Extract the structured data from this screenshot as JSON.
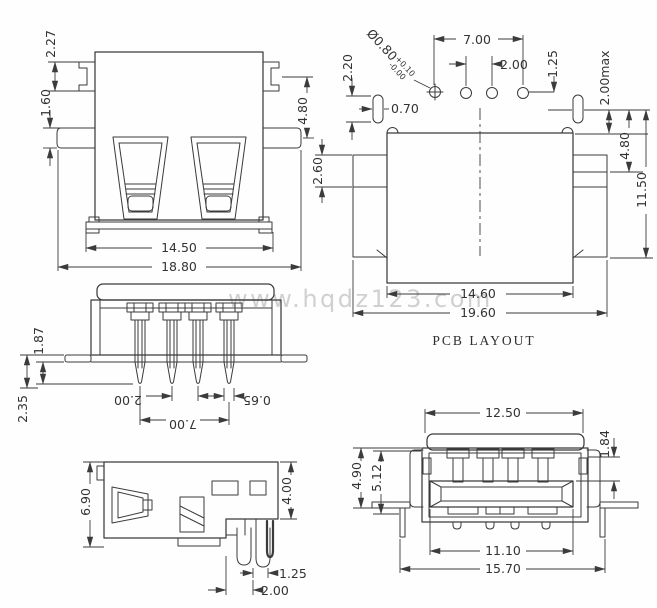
{
  "colors": {
    "line": "#3b3b3b",
    "text": "#333333",
    "watermark": "#c9c9c9",
    "background": "#ffffff"
  },
  "watermark": "www.hqdz123.com",
  "views": {
    "rear": {
      "d_ear_height": "2.27",
      "d_tab_height": "1.60",
      "d_side_height": "4.80",
      "d_flange_width": "14.50",
      "d_total_width": "18.80"
    },
    "pcb": {
      "caption": "PCB LAYOUT",
      "hole_dia": "Ø0.80",
      "hole_tol_plus": "+0.10",
      "hole_tol_minus": "-0.00",
      "pin_span": "7.00",
      "pin_pitch": "2.00",
      "d_offset": "1.25",
      "slot_height": "2.20",
      "slot_width": "0.70",
      "d_max": "2.00max",
      "d_depth1": "4.80",
      "d_depth2": "11.50",
      "d_notch": "2.60",
      "d_inner_width": "14.60",
      "d_outer_width": "19.60"
    },
    "top": {
      "d_pin_len1": "1.87",
      "d_pin_len2": "2.35",
      "d_pin_width": "0.65",
      "d_pin_pitch": "2.00",
      "d_pin_span": "7.00"
    },
    "side": {
      "d_height": "6.90",
      "d_body": "4.00",
      "d_pin_offset": "1.25",
      "d_pin_pitch": "2.00"
    },
    "front": {
      "d_cap_width": "12.50",
      "d_contact": "1.84",
      "d_h1": "4.90",
      "d_h2": "5.12",
      "d_tongue": "11.10",
      "d_leg_span": "15.70"
    }
  }
}
